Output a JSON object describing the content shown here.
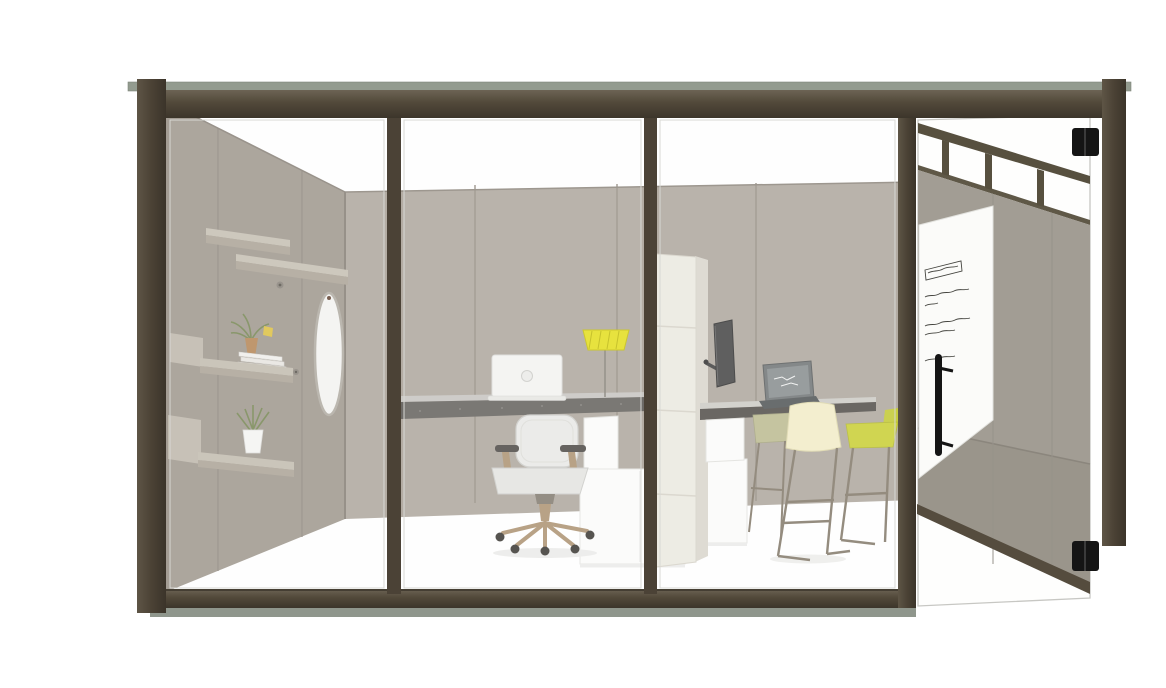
{
  "meta": {
    "title": "Office pod rendering",
    "description": "3D rendering of a freestanding office pod with a bronze-framed glass front, an open glass door with a writable markerboard panel, two height-adjustable desks, a white task chair, bar stools, wall shelves and an oval mirror"
  },
  "colors": {
    "background": "#ffffff",
    "frame_bronze": "#4b4236",
    "frame_cap_green": "#939b8f",
    "plinth_green": "#8f968c",
    "wall_back": "#b3aca3",
    "wall_left": "#a49d94",
    "wall_seam": "#9c958c",
    "door_gray_upper": "#a29d94",
    "door_gray_lower": "#969186",
    "door_rail": "#554c3e",
    "markerboard_white": "#fbfbf9",
    "ink": "#44443f",
    "quilt_screen": "#edebe3",
    "storage_white": "#fcfcfb",
    "desk_edge_dark": "#6d6a66",
    "desk_top_light": "#cac8c4",
    "desk2_edge": "#5b5753",
    "chair_white": "#eaeae8",
    "chair_base_tan": "#b2997a",
    "lamp_yellow": "#e6e02a",
    "laptop_white": "#f4f4f2",
    "laptop_dark_body": "#5a5e5f",
    "laptop_dark_screen": "#8e9395",
    "monitor_dark": "#4e4e4e",
    "stool_cream": "#f3eecb",
    "stool_yellow": "#ccd23f",
    "stool_sage": "#c0bf97",
    "stool_frame": "#8a8172",
    "plant_green": "#7d8d5c",
    "vase_amber": "#b98d5f",
    "hardware_black": "#151515",
    "glass_edge": "#c7c7c3"
  },
  "objects": {
    "glass_front": "bronze-framed glass front with three fixed panels",
    "door": "open glass door with clerestory band, gray privacy panels and white markerboard",
    "markerboard": "illegible handwritten notes: boxed heading plus three short paragraphs",
    "shelves": "three staggered wall shelves with books, plants and vase",
    "mirror": "tall oval mirror on side wall",
    "desk_1": "height-adjustable desk with white laptop and yellow task lamp",
    "chair": "white task chair with tan five-star base",
    "screen_tower": "cream quilted privacy tower with monitor arm and display",
    "desk_2": "standing-height table with dark laptop",
    "stools": "sage, cream and yellow bar stools with bronze wire legs",
    "storage": "white storage cubes below desks"
  }
}
